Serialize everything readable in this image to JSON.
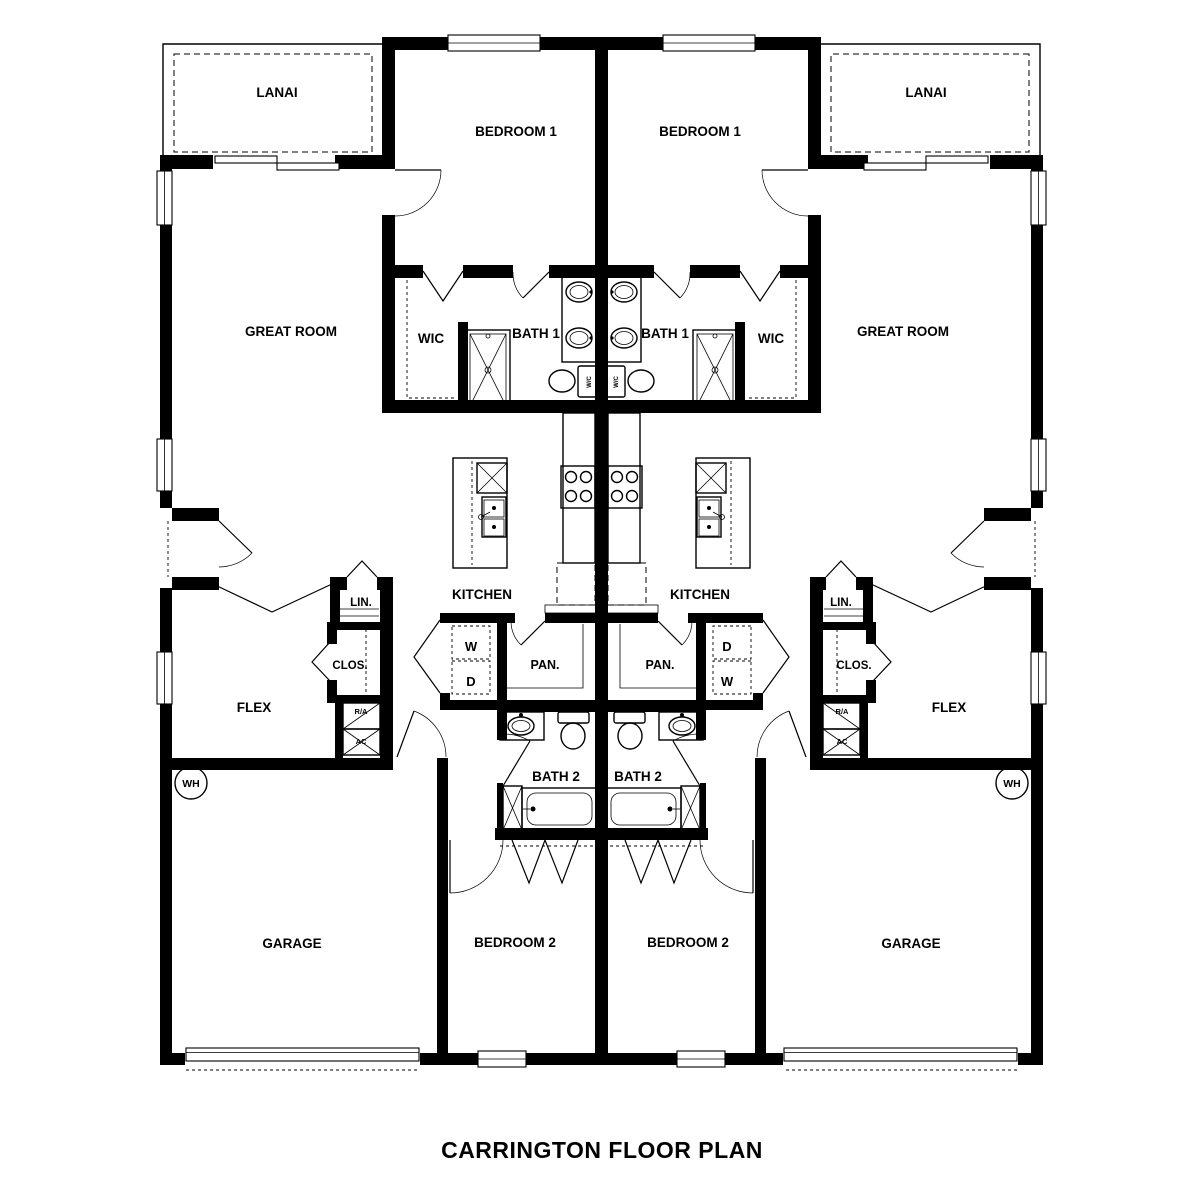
{
  "title": "CARRINGTON FLOOR PLAN",
  "colors": {
    "walls": "#000000",
    "background": "#ffffff"
  },
  "labels": {
    "lanai": "LANAI",
    "bedroom1": "BEDROOM 1",
    "great_room": "GREAT ROOM",
    "wic": "WIC",
    "bath1": "BATH 1",
    "kitchen": "KITCHEN",
    "linen": "LIN.",
    "closet": "CLOS.",
    "pantry": "PAN.",
    "washer": "W",
    "dryer": "D",
    "return_air": "R/A",
    "ac": "AC",
    "water_heater": "WH",
    "water_closet": "W/C",
    "flex": "FLEX",
    "bath2": "BATH 2",
    "garage": "GARAGE",
    "bedroom2": "BEDROOM 2"
  }
}
